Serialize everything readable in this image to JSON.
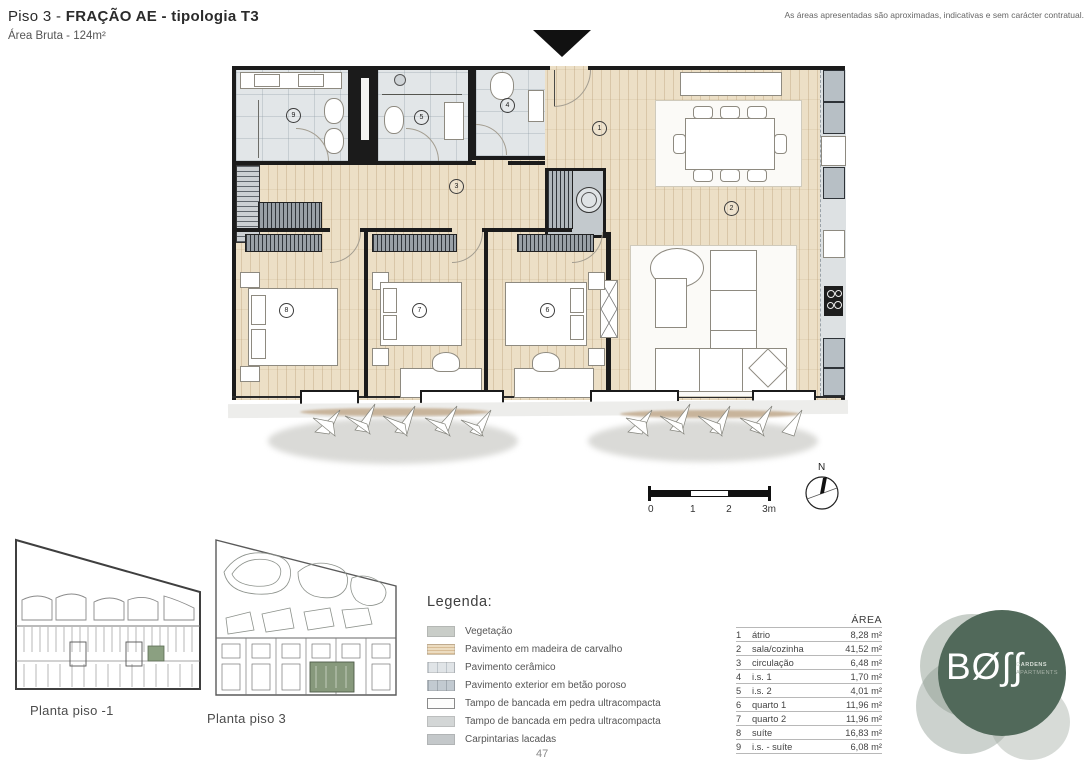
{
  "header": {
    "title_prefix": "Piso 3 - ",
    "title_bold": "FRAÇÃO AE - tipologia T3",
    "subtitle": "Área Bruta - 124m²",
    "disclaimer": "As áreas apresentadas são aproximadas, indicativas e sem carácter contratual."
  },
  "scalebar": {
    "labels": [
      "0",
      "1",
      "2",
      "3m"
    ]
  },
  "north": {
    "label": "N"
  },
  "legend": {
    "title": "Legenda:",
    "items": [
      {
        "label": "Vegetação"
      },
      {
        "label": "Pavimento em madeira de carvalho"
      },
      {
        "label": "Pavimento cerâmico"
      },
      {
        "label": "Pavimento exterior em betão poroso"
      },
      {
        "label": "Tampo de bancada em pedra ultracompacta"
      },
      {
        "label": "Tampo de bancada em pedra ultracompacta"
      },
      {
        "label": "Carpintarias lacadas"
      }
    ]
  },
  "areas_table": {
    "header": "ÁREA",
    "rows": [
      {
        "num": "1",
        "name": "átrio",
        "area": "8,28 m²"
      },
      {
        "num": "2",
        "name": "sala/cozinha",
        "area": "41,52 m²"
      },
      {
        "num": "3",
        "name": "circulação",
        "area": "6,48 m²"
      },
      {
        "num": "4",
        "name": "i.s. 1",
        "area": "1,70 m²"
      },
      {
        "num": "5",
        "name": "i.s. 2",
        "area": "4,01 m²"
      },
      {
        "num": "6",
        "name": "quarto 1",
        "area": "11,96 m²"
      },
      {
        "num": "7",
        "name": "quarto 2",
        "area": "11,96 m²"
      },
      {
        "num": "8",
        "name": "suíte",
        "area": "16,83 m²"
      },
      {
        "num": "9",
        "name": "i.s. - suíte",
        "area": "6,08 m²"
      }
    ]
  },
  "miniplans": [
    {
      "label": "Planta piso -1"
    },
    {
      "label": "Planta piso 3"
    }
  ],
  "logo": {
    "brand": "BØ∫∫",
    "tag1": "GARDENS",
    "tag2": "APARTMENTS"
  },
  "page_number": "47",
  "colors": {
    "brand_green": "#51695a",
    "highlight_green": "#87997c",
    "wood_floor": "#ecdfc6",
    "ceramic_floor": "#e2e6e8",
    "wall": "#1b1b1b"
  }
}
